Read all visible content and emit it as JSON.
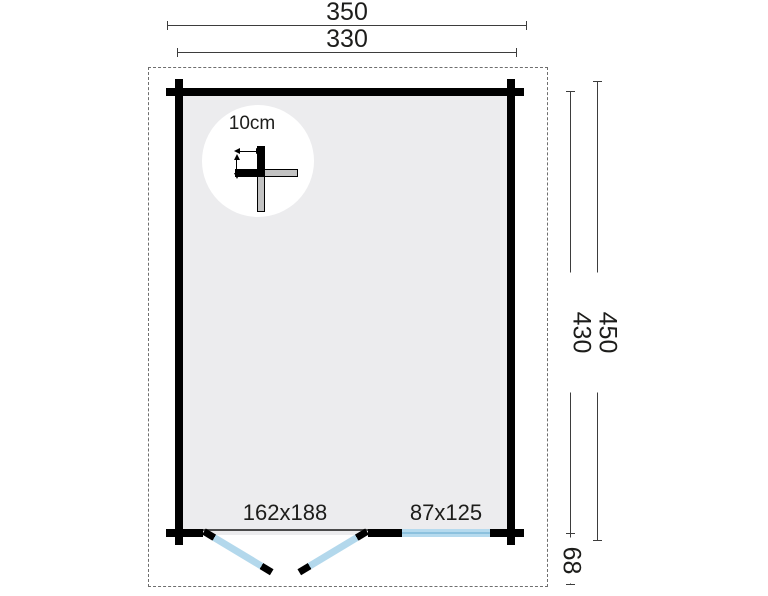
{
  "plan": {
    "title": "garden house floor plan",
    "dimensions": {
      "overall_width": "350",
      "wall_width": "330",
      "overall_depth": "450",
      "wall_depth": "430",
      "front_clearance": "68"
    },
    "openings": {
      "double_door_size": "162x188",
      "window_size": "87x125"
    },
    "wall_detail": {
      "thickness_label": "10cm"
    },
    "colors": {
      "wall": "#000000",
      "interior": "#ececee",
      "glazing": "#b5daee",
      "glazing_line": "#8cc1de",
      "dim_line": "#3d3d3d",
      "text": "#1d1d1b",
      "boundary_dash": "#6e6e6e"
    }
  }
}
